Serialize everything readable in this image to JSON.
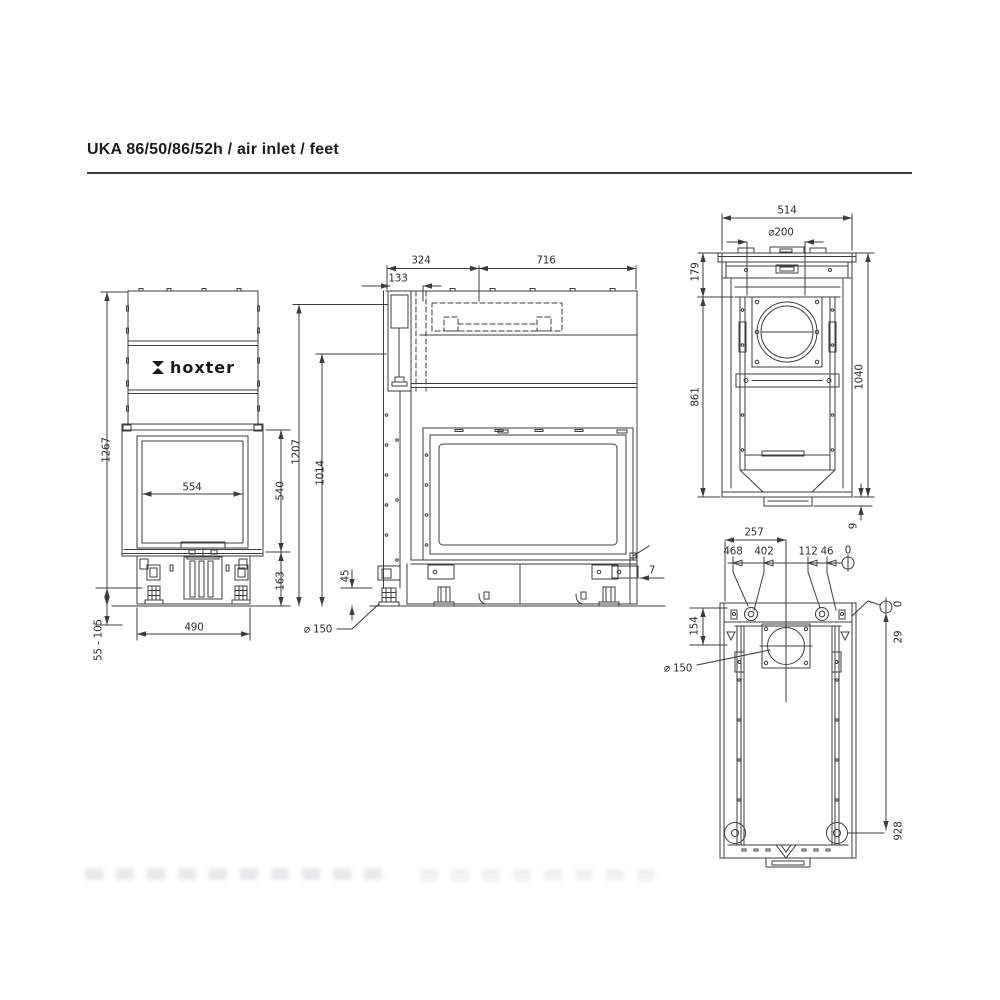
{
  "title": "UKA 86/50/86/52h / air inlet / feet",
  "brand": {
    "logo_text": "hoxter"
  },
  "views": {
    "front": {
      "overall_height": "1267",
      "glass_width": "554",
      "glass_height": "540",
      "base_height": "163",
      "base_width": "490",
      "foot_adjust_range": "55 - 105"
    },
    "side": {
      "height_connector": "1207",
      "height_body": "1014",
      "depth_rear": "324",
      "pipe_offset": "133",
      "depth_front": "716",
      "foot_height": "45",
      "air_inlet_diameter": "⌀ 150",
      "rear_gap": "7"
    },
    "rear": {
      "width": "514",
      "flue_diameter": "⌀200",
      "collar_height": "179",
      "body_height": "861",
      "overall_height": "1040",
      "base_plate_height": "9"
    },
    "plan": {
      "flue_center_offset": "257",
      "hole_positions": [
        "468",
        "402",
        "112",
        "46",
        "0"
      ],
      "flue_axis_offset": "154",
      "datum_zero": "0",
      "hole_row_offset": "29",
      "air_inlet_diameter": "⌀ 150",
      "feet_distance": "928"
    }
  }
}
